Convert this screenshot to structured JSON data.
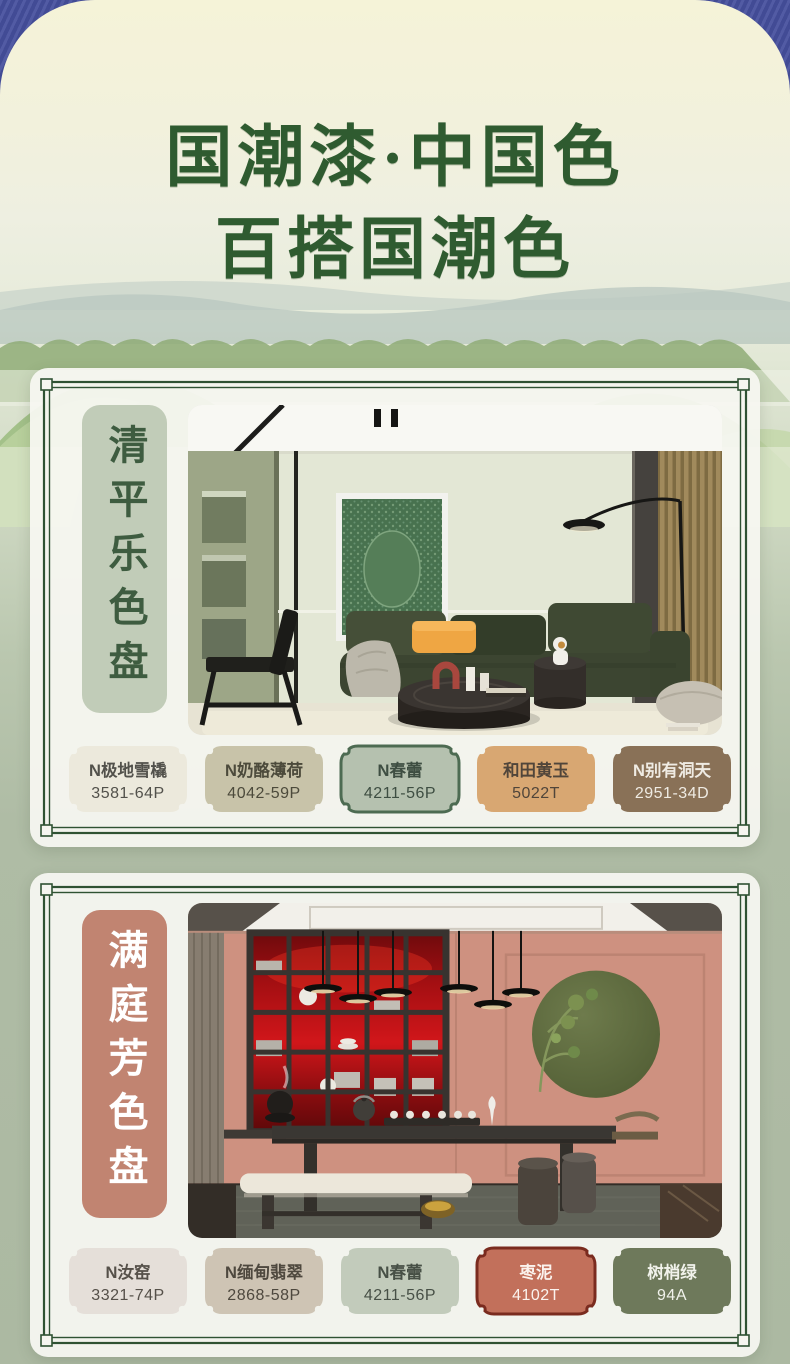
{
  "page": {
    "title_line1": "国潮漆·中国色",
    "title_line2": "百搭国潮色",
    "title_color": "#2F5B30",
    "backdrop_color": "#47519E",
    "canvas_top_color": "#F5F3D8",
    "canvas_bottom_color": "#ACB9A2",
    "frame_color": "#2F5233"
  },
  "panels": [
    {
      "label": "清平乐色盘",
      "label_bg": "#C1CCB8",
      "label_fg": "#3E5C40",
      "photo_alt": "sage-green living room with dark green sofa, orange pillow, round black coffee table, green artwork and arc floor lamp",
      "swatches": [
        {
          "name": "N极地雪橇",
          "code": "3581-64P",
          "bg": "#ECE9DC",
          "fg": "#52514B",
          "border": "none"
        },
        {
          "name": "N奶酪薄荷",
          "code": "4042-59P",
          "bg": "#C8C3A9",
          "fg": "#4C4A3B",
          "border": "none"
        },
        {
          "name": "N春蕾",
          "code": "4211-56P",
          "bg": "#B5C1AF",
          "fg": "#3E4E42",
          "border": "#4D6B52"
        },
        {
          "name": "和田黄玉",
          "code": "5022T",
          "bg": "#D8A772",
          "fg": "#50453A",
          "border": "none"
        },
        {
          "name": "N别有洞天",
          "code": "2951-34D",
          "bg": "#897157",
          "fg": "#EFEBE3",
          "border": "none"
        }
      ]
    },
    {
      "label": "满庭芳色盘",
      "label_bg": "#C18471",
      "label_fg": "#FFFFFF",
      "photo_alt": "terracotta pink tea room with red backlit shelving, pendant lights, dark tea table, cream bench and olive green moon disc",
      "swatches": [
        {
          "name": "N汝窑",
          "code": "3321-74P",
          "bg": "#E5DFD9",
          "fg": "#555049",
          "border": "none"
        },
        {
          "name": "N缅甸翡翠",
          "code": "2868-58P",
          "bg": "#CEC4B4",
          "fg": "#4E483E",
          "border": "none"
        },
        {
          "name": "N春蕾",
          "code": "4211-56P",
          "bg": "#C2CBBB",
          "fg": "#475046",
          "border": "none"
        },
        {
          "name": "枣泥",
          "code": "4102T",
          "bg": "#C2705B",
          "fg": "#FBF3EE",
          "border": "#7A2B1F"
        },
        {
          "name": "树梢绿",
          "code": "94A",
          "bg": "#6E795B",
          "fg": "#F1F2EB",
          "border": "none"
        }
      ]
    }
  ]
}
